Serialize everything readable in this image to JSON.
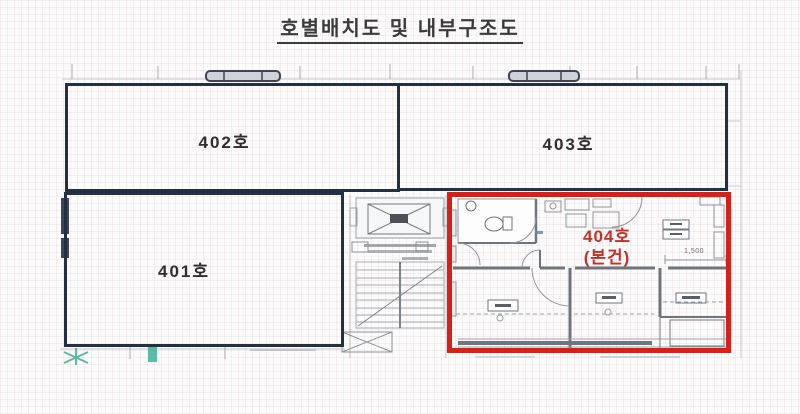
{
  "title": "호별배치도 및 내부구조도",
  "units": {
    "u401": {
      "label": "401호"
    },
    "u402": {
      "label": "402호"
    },
    "u403": {
      "label": "403호"
    },
    "u404": {
      "label_line1": "404호",
      "label_line2": "(본건)"
    }
  },
  "floorplan": {
    "dimension_label": "1,500"
  },
  "colors": {
    "unit_border": "#232f42",
    "highlight_border": "#dc1f16",
    "highlight_text": "#c23127",
    "plan_line_gray": "#8f949b",
    "wall_gray": "#70757c",
    "teal_mark": "#3fae96",
    "title_color": "#3b3b3b"
  }
}
